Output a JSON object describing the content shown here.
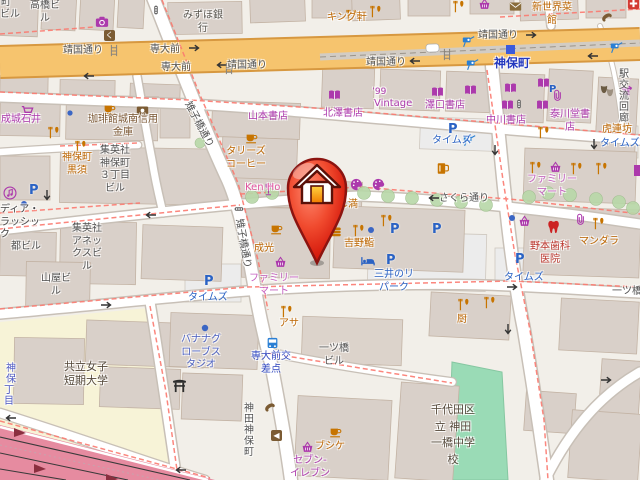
{
  "colors": {
    "land": "#f2efe9",
    "building": "#d9d0c9",
    "building_outline": "#c3b3a4",
    "main_road": "#f6c46e",
    "main_road_casing": "#d79840",
    "motorway": "#e68ba0",
    "park_green": "#9adbb6",
    "tree_green": "#b8d8a8",
    "university_landuse": "#f7f3d7",
    "parking_lot": "#ececec",
    "shop_purple": "#ac39ac",
    "restaurant_amber": "#bc6500",
    "parking_blue": "#2a62c4",
    "station_blue": "#2438be",
    "medical_red": "#bb352c",
    "footpath_dash_red": "#fb7a70",
    "pin_red": "#e01f12"
  },
  "icons": {
    "parking_letter": "P",
    "badge_ku": "く",
    "badge_chevron": "◀",
    "logo_99": "’99"
  },
  "marker": {
    "name": "house-pin"
  },
  "labels": {
    "machi_frag": "町",
    "biru_frag": "ビル",
    "takahashi": "高橋ビ\nル",
    "mizuho": "みずほ銀\n行",
    "kingken": "キング軒",
    "shinsekai": "新世界菜\n館",
    "yasukuni_a": "靖国通り",
    "yasukuni_b": "靖国通り",
    "yasukuni_c": "靖国通り",
    "yasukuni_d": "靖国通り",
    "sendaimae_a": "専大前",
    "sendaimae_b": "専大前",
    "jimbocho_station": "神保町",
    "ekikoryu": "駅交流回廊",
    "seijoishii": "成城石井",
    "kohikan": "珈琲館城南信用\n金庫",
    "yamamoto": "山本書店",
    "kitazawa": "北澤書店",
    "vintage": "Vintage",
    "sawaguchi": "澤口書店",
    "nakagawa": "中川書店",
    "taisendo": "泰川堂書\n店",
    "torenbo": "虎連坊",
    "kijibashi_a": "雉子橋通り",
    "kijibashi_b": "雉子橋通り",
    "kurosu": "神保町\n黒須",
    "shueisha3": "集英社\n神保町\n３丁目\nビル",
    "tullys": "タリーズ\nコーヒー",
    "kenho": "Ken Ho",
    "tsukijiman": "つきじ満",
    "times1": "タイムズ",
    "times2": "タイムズ",
    "times3": "タイムズ",
    "times4": "タイムズ",
    "famima1": "ファミリー\nマート",
    "famima2": "ファミリー\nマート",
    "mandala": "マンダラ",
    "nomoto": "野本歯科\n医院",
    "mitsui_repark": "三井のリ\nパーク",
    "yoshinozushi": "吉野鮨",
    "seiko": "成光",
    "asa": "アサ",
    "sendai_kosaten": "専大前交\n差点",
    "banana": "バナナグ\nローブス\nタジオ",
    "kyoritsu": "共立女子\n短期大学",
    "hitotsubashi_biru": "一ツ橋\nビル",
    "kuriya": "厨",
    "hitotsubashi_frag": "一ツ橋",
    "chiyoda_school": "千代田区\n立 神田\n一橋中学\n校",
    "bushike": "ブシケ",
    "seveneleven": "セブン-\nイレブン",
    "miyako_biru": "都ビル",
    "media_classic": "ディア・\nラッシッ\nク",
    "yamaya": "山屋ビ\nル",
    "shueisha_annex": "集英社\nアネッ\nクスビ\nル",
    "kanda_jimbocho": "神田神保町",
    "sakura_dori": "さくら通り",
    "jimbo_frag": "神保",
    "chome_frag": "丁目"
  }
}
